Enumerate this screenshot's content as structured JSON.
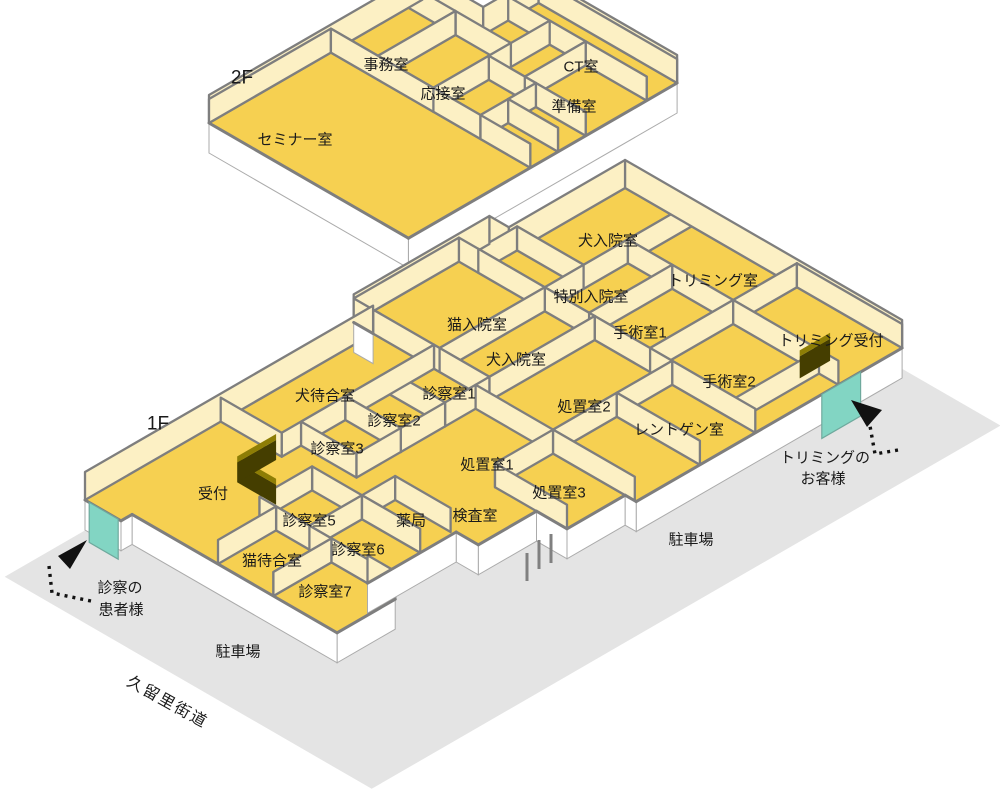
{
  "title": "動物病院 フロアマップ (1F / 2F)",
  "colors": {
    "floor": "#F6D051",
    "wall": "#FCF0C4",
    "wall_line": "#7E7E7E",
    "ground": "#E4E4E4",
    "base": "#FFFFFF",
    "base_line": "#ABABAB",
    "door": "#82D5C3",
    "door_line": "#6FA99D",
    "counter_side": "#453E00",
    "counter_top": "#8D7D05",
    "arrow": "#111111",
    "bar": "#808080",
    "label": "#1A1A1A"
  },
  "iso": {
    "ux": 27.7,
    "uy": 16
  },
  "floors": [
    {
      "id": "2F",
      "origin": [
        209,
        123
      ],
      "footprint": [
        [
          0,
          0
        ],
        [
          0,
          7.7
        ],
        [
          2.2,
          7.7
        ],
        [
          2.2,
          9.7
        ],
        [
          7.2,
          9.7
        ],
        [
          7.2,
          0
        ]
      ],
      "rooms": [
        {
          "name": "セミナー室",
          "rect": [
            0,
            0,
            7.2,
            4.4
          ],
          "label": [
            295,
            140
          ]
        },
        {
          "name": "事務室",
          "rect": [
            0,
            4.4,
            1.7,
            7.2
          ],
          "label": [
            386,
            65
          ]
        },
        {
          "name": "応接室",
          "rect": [
            1.7,
            4.4,
            3.7,
            7.2
          ],
          "label": [
            443,
            94
          ]
        },
        {
          "name": "CT室",
          "rect": [
            2.2,
            8.6,
            7.2,
            9.7
          ],
          "label": [
            581,
            67
          ]
        },
        {
          "name": "準備室",
          "rect": [
            5.0,
            6.4,
            7.2,
            8.6
          ],
          "label": [
            574,
            107
          ]
        },
        {
          "name": "",
          "rect": [
            3.7,
            4.4,
            5.4,
            6.4
          ]
        },
        {
          "name": "",
          "rect": [
            5.4,
            4.4,
            7.2,
            5.4
          ]
        },
        {
          "name": "",
          "rect": [
            5.4,
            5.4,
            7.2,
            6.4
          ]
        },
        {
          "name": "",
          "rect": [
            3.7,
            6.4,
            5.0,
            8.6
          ]
        }
      ]
    },
    {
      "id": "1F",
      "origin": [
        85,
        500
      ],
      "footprint": [
        [
          0,
          0
        ],
        [
          0,
          10.4
        ],
        [
          -0.7,
          10.4
        ],
        [
          -0.7,
          15.3
        ],
        [
          0,
          15.3
        ],
        [
          0,
          19.5
        ],
        [
          10,
          19.5
        ],
        [
          10,
          9.9
        ],
        [
          9.6,
          9.9
        ],
        [
          9.6,
          7.8
        ],
        [
          8.5,
          7.8
        ],
        [
          8.5,
          5.7
        ],
        [
          7.7,
          5.7
        ],
        [
          7.7,
          2.5
        ],
        [
          8.7,
          2.5
        ],
        [
          8.7,
          0.4
        ],
        [
          1.3,
          0.4
        ],
        [
          1.3,
          0
        ]
      ],
      "rooms": [
        {
          "name": "犬待合室",
          "rect": [
            0,
            4.9,
            2.2,
            10.4
          ],
          "label": [
            325,
            396
          ]
        },
        {
          "name": "猫入院室",
          "rect": [
            -0.7,
            10.4,
            2.4,
            14.2
          ],
          "label": [
            477,
            325
          ]
        },
        {
          "name": "",
          "rect": [
            0,
            14.2,
            2.4,
            15.6
          ]
        },
        {
          "name": "犬入院室",
          "rect": [
            0,
            15.6,
            2.4,
            19.5
          ],
          "label": [
            608,
            241
          ]
        },
        {
          "name": "特別入院室",
          "rect": [
            2.4,
            14.2,
            4.0,
            17.2
          ],
          "label": [
            591,
            297
          ]
        },
        {
          "name": "犬入院室",
          "rect": [
            2.4,
            10.4,
            4.2,
            14.2
          ],
          "label": [
            516,
            360
          ]
        },
        {
          "name": "トリミング室",
          "rect": [
            2.4,
            17.2,
            6.2,
            19.5
          ],
          "label": [
            713,
            281
          ]
        },
        {
          "name": "手術室1",
          "rect": [
            4.0,
            14.2,
            6.2,
            17.2
          ],
          "label": [
            640,
            333
          ]
        },
        {
          "name": "手術室2",
          "rect": [
            6.2,
            14.2,
            9.3,
            17.2
          ],
          "label": [
            729,
            382
          ]
        },
        {
          "name": "トリミング受付",
          "rect": [
            6.2,
            17.2,
            10,
            19.5
          ],
          "label": [
            831,
            341
          ]
        },
        {
          "name": "診察室1",
          "rect": [
            2.2,
            8.8,
            4.2,
            10.4
          ],
          "label": [
            449,
            394
          ]
        },
        {
          "name": "診察室2",
          "rect": [
            2.2,
            7.2,
            4.2,
            8.8
          ],
          "label": [
            394,
            421
          ]
        },
        {
          "name": "診察室3",
          "rect": [
            2.2,
            5.6,
            4.2,
            7.2
          ],
          "label": [
            337,
            449
          ]
        },
        {
          "name": "処置室2",
          "rect": [
            4.2,
            9.9,
            7.0,
            14.2
          ],
          "label": [
            584,
            407
          ]
        },
        {
          "name": "",
          "rect": [
            7.0,
            9.9,
            9.95,
            12.2
          ]
        },
        {
          "name": "レントゲン室",
          "rect": [
            7.0,
            12.2,
            10,
            14.2
          ],
          "label": [
            679,
            430
          ]
        },
        {
          "name": "処置室1",
          "rect": null,
          "label": [
            487,
            465
          ]
        },
        {
          "name": "検査室",
          "rect": null,
          "label": [
            475,
            516
          ]
        },
        {
          "name": "処置室3",
          "rect": [
            7.0,
            7.8,
            9.6,
            9.9
          ],
          "label": [
            559,
            493
          ]
        },
        {
          "name": "薬局",
          "rect": [
            5.6,
            4.4,
            7.6,
            5.6
          ],
          "label": [
            411,
            521
          ]
        },
        {
          "name": "診察室5",
          "rect": [
            3.8,
            2.5,
            5.6,
            4.4
          ],
          "label": [
            309,
            521
          ]
        },
        {
          "name": "診察室6",
          "rect": [
            5.6,
            2.5,
            7.7,
            4.4
          ],
          "label": [
            358,
            550
          ]
        },
        {
          "name": "猫待合室",
          "rect": [
            4.4,
            0.4,
            6.4,
            2.5
          ],
          "label": [
            272,
            561
          ]
        },
        {
          "name": "診察室7",
          "rect": [
            6.4,
            0.4,
            8.7,
            2.5
          ],
          "label": [
            325,
            592
          ]
        },
        {
          "name": "受付",
          "rect": null,
          "label": [
            213,
            494
          ]
        }
      ]
    }
  ],
  "ground": {
    "floor_ref": "1F",
    "poly": [
      [
        0.95,
        -3.85
      ],
      [
        0.95,
        18.85
      ],
      [
        14.2,
        18.85
      ],
      [
        14.2,
        -3.85
      ]
    ]
  },
  "props": {
    "doors": [
      {
        "floor": "1F",
        "p1": [
          1.2,
          0
        ],
        "p2": [
          0.15,
          0
        ],
        "h": 40,
        "name": "patient-entrance-door"
      },
      {
        "floor": "1F",
        "p1": [
          10,
          16.6
        ],
        "p2": [
          10,
          18.0
        ],
        "h": 44,
        "name": "trimming-entrance-door"
      }
    ],
    "counters": [
      {
        "floor": "1F",
        "path": [
          [
            3.6,
            3.3
          ],
          [
            2.2,
            3.3
          ],
          [
            2.2,
            4.7
          ]
        ],
        "h": 20,
        "name": "reception-counter"
      },
      {
        "floor": "1F",
        "path": [
          [
            9.1,
            16.7
          ],
          [
            9.1,
            17.8
          ]
        ],
        "h": 22,
        "name": "trimming-counter"
      }
    ],
    "bars": [
      [
        527,
        553,
        527,
        581
      ],
      [
        539,
        540,
        539,
        569
      ],
      [
        551,
        534,
        551,
        563
      ]
    ],
    "arrows": [
      {
        "name": "patient-route-arrow",
        "path": "M 91 601 L 52 593 L 49 566",
        "head": [
          [
            87,
            540
          ],
          [
            58,
            556
          ],
          [
            70,
            569
          ]
        ]
      },
      {
        "name": "trimming-route-arrow",
        "path": "M 898 450 L 875 454 L 870 426",
        "head": [
          [
            851,
            400
          ],
          [
            882,
            410
          ],
          [
            867,
            427
          ]
        ]
      }
    ]
  },
  "annotations": [
    {
      "text": "2F",
      "x": 242,
      "y": 78,
      "size": 19,
      "kind": "floor-tag"
    },
    {
      "text": "1F",
      "x": 158,
      "y": 424,
      "size": 19,
      "kind": "floor-tag"
    },
    {
      "text": "駐車場",
      "x": 691,
      "y": 540,
      "size": 15,
      "kind": "ground-label"
    },
    {
      "text": "駐車場",
      "x": 238,
      "y": 652,
      "size": 15,
      "kind": "ground-label"
    },
    {
      "text": "久留里街道",
      "x": 167,
      "y": 703,
      "size": 16,
      "rotate": true,
      "kind": "road-label"
    },
    {
      "text": "トリミングの",
      "x": 825,
      "y": 458,
      "size": 15,
      "kind": "guide-label"
    },
    {
      "text": "お客様",
      "x": 823,
      "y": 479,
      "size": 15,
      "kind": "guide-label"
    },
    {
      "text": "診察の",
      "x": 120,
      "y": 588,
      "size": 15,
      "kind": "guide-label"
    },
    {
      "text": "患者様",
      "x": 121,
      "y": 610,
      "size": 15,
      "kind": "guide-label"
    }
  ]
}
